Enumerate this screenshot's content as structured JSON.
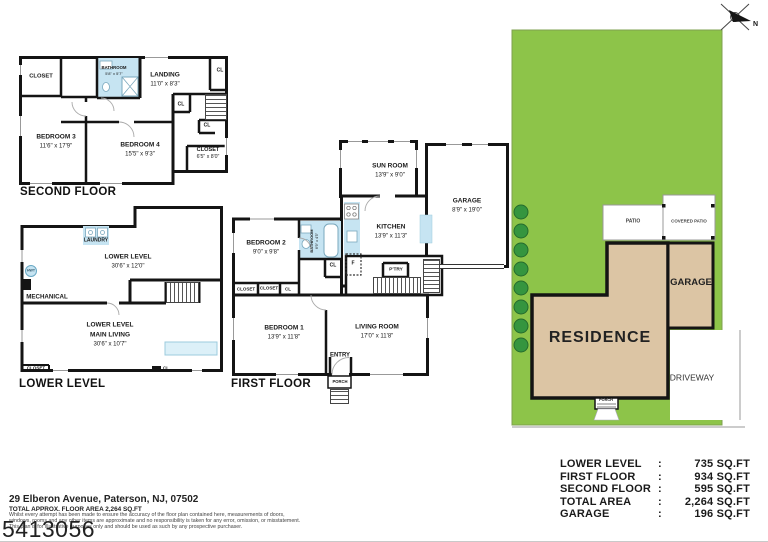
{
  "colors": {
    "lot_green": "#8dc449",
    "bush_green": "#35953f",
    "building_tan": "#dcc5a4",
    "fixture_blue": "#c6e4f2",
    "wall_black": "#141414"
  },
  "header": {
    "compass_label": "N"
  },
  "second_floor": {
    "title": "SECOND FLOOR",
    "rooms": {
      "closet_tl": {
        "name": "CLOSET"
      },
      "bathroom": {
        "name": "BATHROOM",
        "dims": "5'8\" x 5'7\""
      },
      "landing": {
        "name": "LANDING",
        "dims": "11'0\" x 8'3\""
      },
      "cl_tr": {
        "name": "CL"
      },
      "cl_mid": {
        "name": "CL"
      },
      "cl_low": {
        "name": "CL"
      },
      "bedroom3": {
        "name": "BEDROOM 3",
        "dims": "11'6\" x 17'9\""
      },
      "bedroom4": {
        "name": "BEDROOM 4",
        "dims": "15'5\" x 9'3\""
      },
      "closet_br": {
        "name": "CLOSET",
        "dims": "6'5\" x 8'0\""
      }
    }
  },
  "lower_level": {
    "title": "LOWER LEVEL",
    "rooms": {
      "laundry": {
        "name": "LAUNDRY"
      },
      "hwt": {
        "name": "HWT"
      },
      "lower_level": {
        "name": "LOWER LEVEL",
        "dims": "30'6\" x 12'0\""
      },
      "mechanical": {
        "name": "MECHANICAL"
      },
      "main_living": {
        "name1": "LOWER LEVEL",
        "name2": "MAIN LIVING",
        "dims": "30'6\" x 10'7\""
      },
      "closet_bl": {
        "name": "CLOSET"
      },
      "cl_b": {
        "name": "CL"
      }
    }
  },
  "first_floor": {
    "title": "FIRST FLOOR",
    "rooms": {
      "sun_room": {
        "name": "SUN ROOM",
        "dims": "13'9\" x 9'0\""
      },
      "garage": {
        "name": "GARAGE",
        "dims": "8'9\" x 19'0\""
      },
      "kitchen": {
        "name": "KITCHEN",
        "dims": "13'9\" x 11'3\""
      },
      "bedroom2": {
        "name": "BEDROOM 2",
        "dims": "9'0\" x 9'8\""
      },
      "bathroom": {
        "name": "BATHROOM",
        "dims": "6'9\" x 4'5\""
      },
      "cl_kitchen": {
        "name": "CL"
      },
      "fridge": {
        "name": "F"
      },
      "pantry": {
        "name": "P'TRY"
      },
      "closet_1": {
        "name": "CLOSET"
      },
      "closet_2": {
        "name": "CLOSET"
      },
      "cl_row": {
        "name": "CL"
      },
      "bedroom1": {
        "name": "BEDROOM 1",
        "dims": "13'9\" x 11'8\""
      },
      "living_room": {
        "name": "LIVING ROOM",
        "dims": "17'0\" x 11'8\""
      },
      "entry": {
        "name": "ENTRY"
      },
      "porch": {
        "name": "PORCH"
      }
    }
  },
  "site_plan": {
    "residence_label": "RESIDENCE",
    "garage_label": "GARAGE",
    "driveway_label": "DRIVEWAY",
    "patio_label": "PATIO",
    "covered_patio_label": "COVERED PATIO",
    "porch_label": "PORCH"
  },
  "area_table": {
    "rows": [
      {
        "label": "LOWER LEVEL",
        "sep": ":",
        "value": "735 SQ.FT"
      },
      {
        "label": "FIRST FLOOR",
        "sep": ":",
        "value": "934 SQ.FT"
      },
      {
        "label": "SECOND FLOOR",
        "sep": ":",
        "value": "595 SQ.FT"
      },
      {
        "label": "TOTAL AREA",
        "sep": ":",
        "value": "2,264 SQ.FT"
      },
      {
        "label": "GARAGE",
        "sep": ":",
        "value": "196 SQ.FT"
      }
    ]
  },
  "footer": {
    "address": "29 Elberon Avenue, Paterson, NJ, 07502",
    "approx_area": "TOTAL APPROX. FLOOR AREA 2,264 SQ.FT",
    "disclaimer_line1": "Whilst every attempt has been made to ensure the accuracy of the floor plan contained here, measurements of doors,",
    "disclaimer_line2": "windows, rooms and any other items are approximate and no responsibility is taken for any error, omission, or misstatement.",
    "disclaimer_line3": "This plan is for illustrative purposes only and should be used as such by any prospective purchaser.",
    "listing_id": "5413056"
  }
}
